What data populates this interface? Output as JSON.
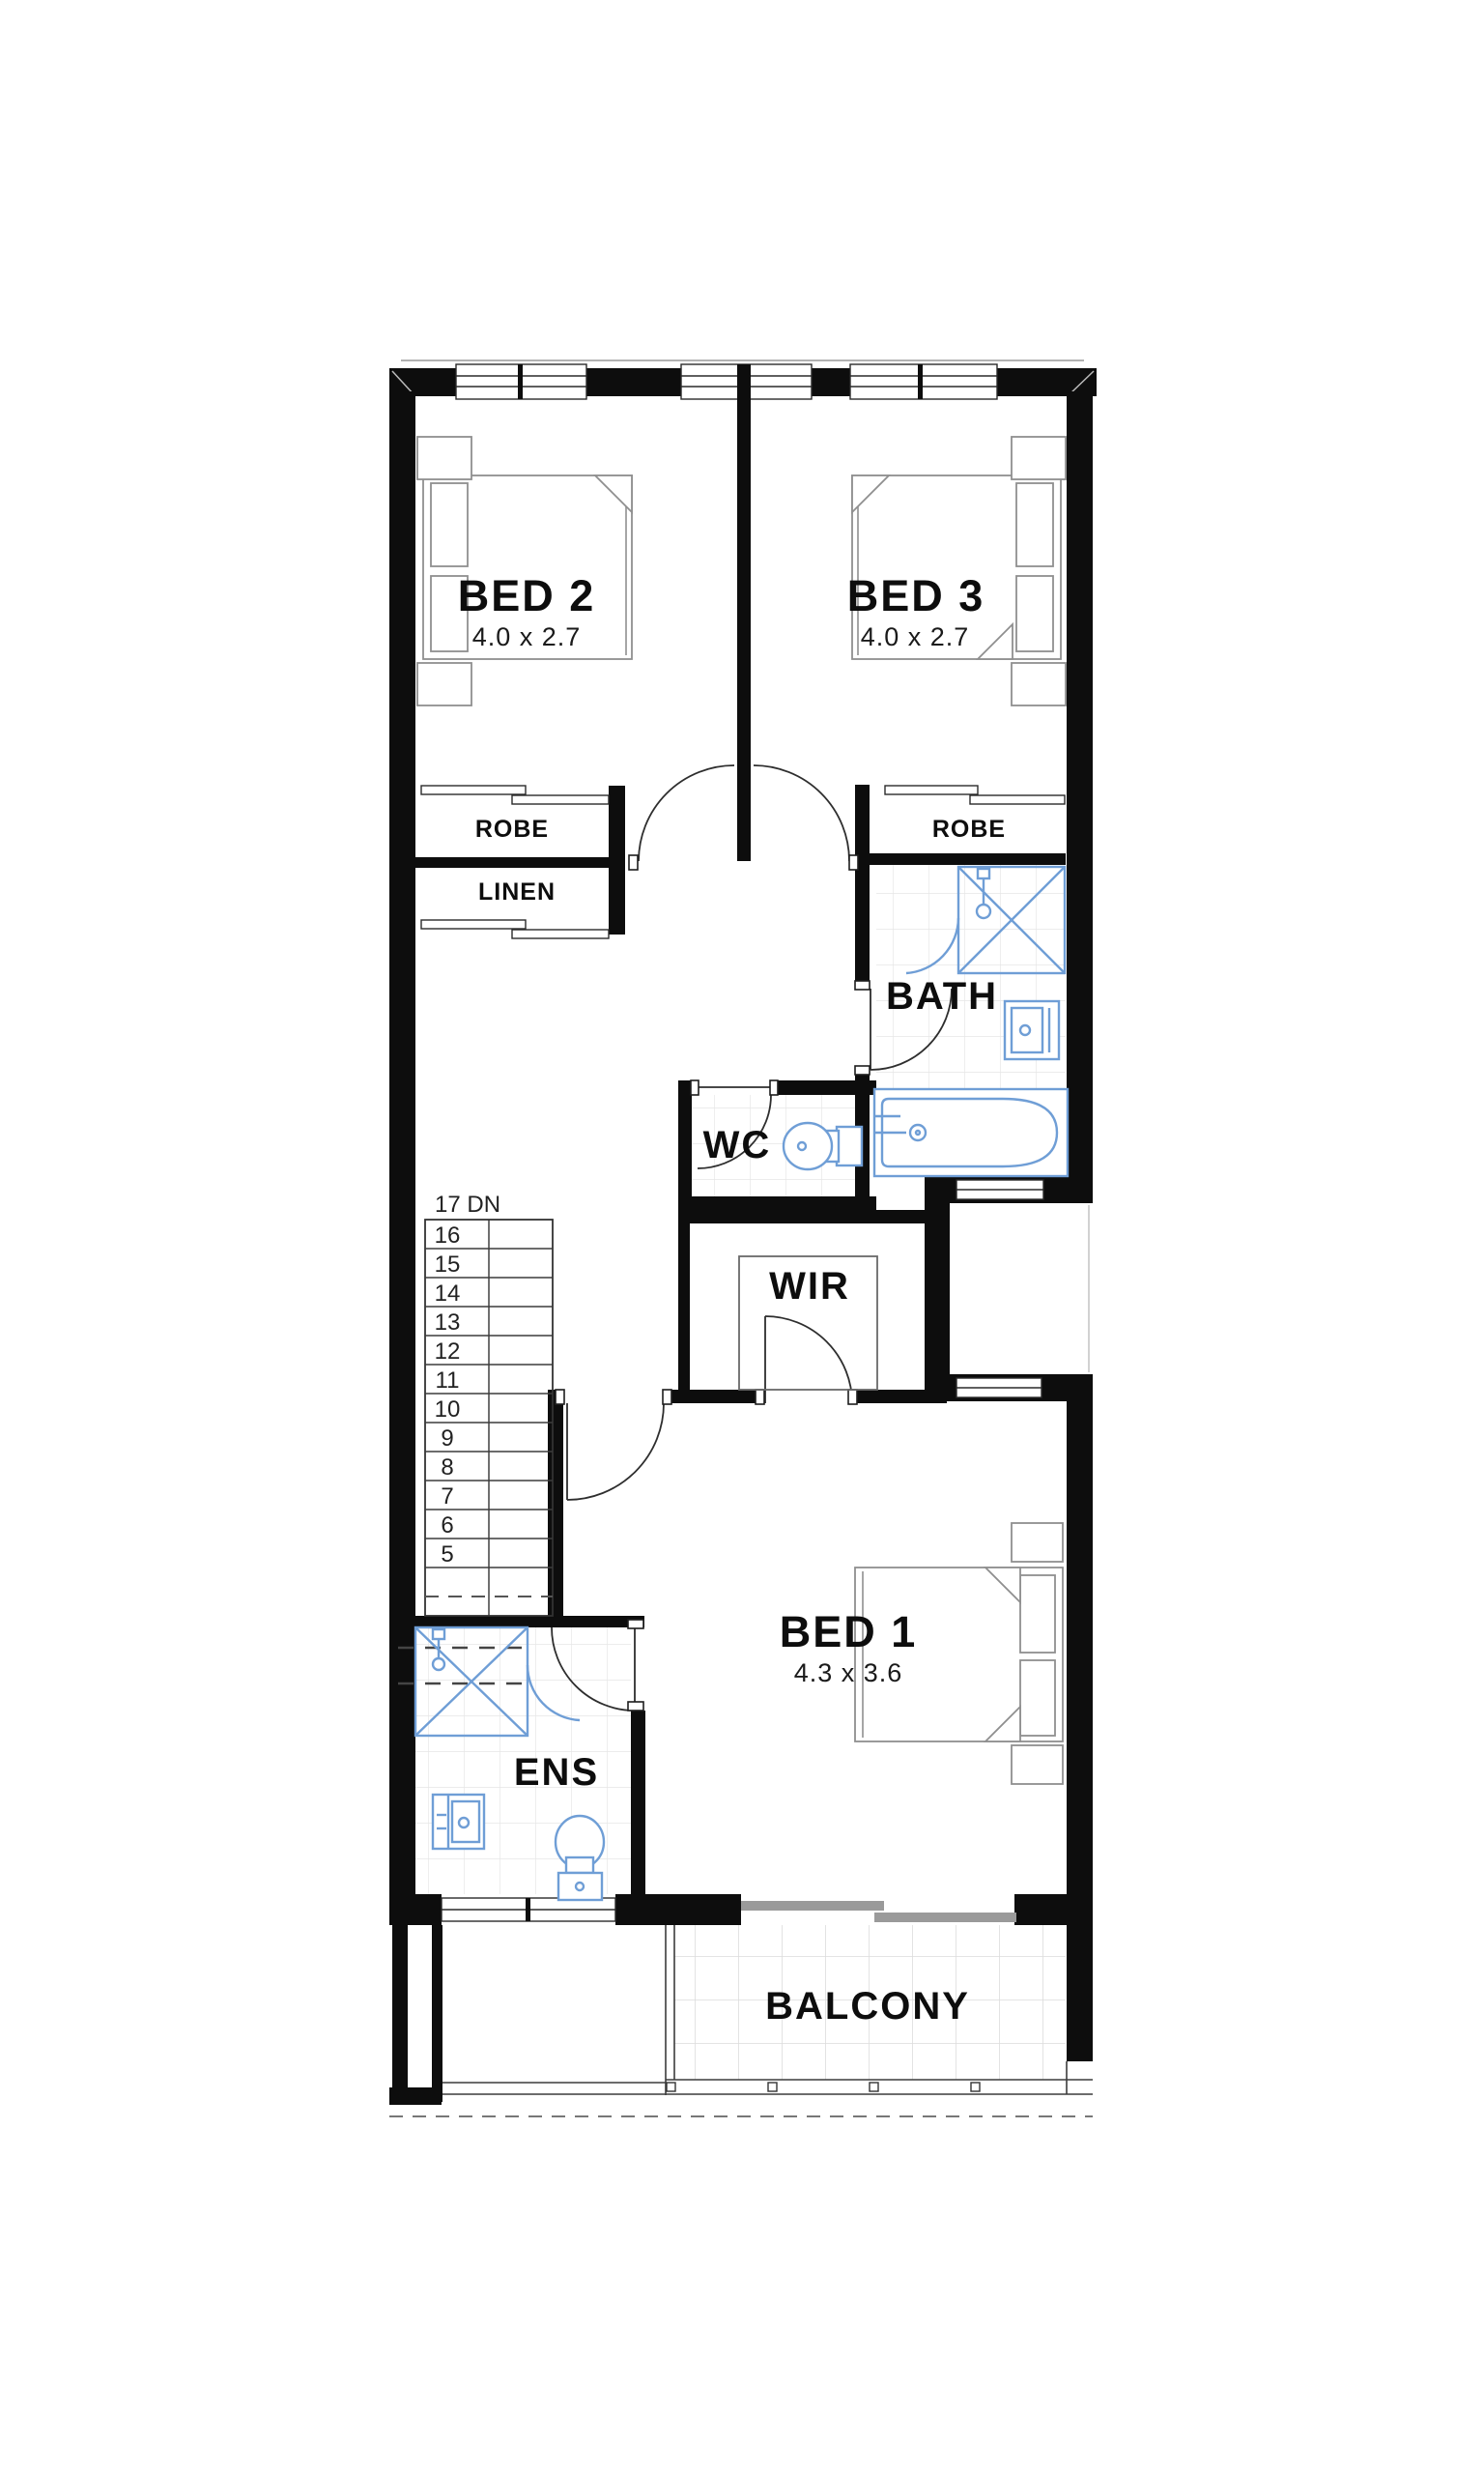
{
  "plan": {
    "rooms": {
      "bed2": {
        "label": "BED 2",
        "dim": "4.0 x 2.7"
      },
      "bed3": {
        "label": "BED 3",
        "dim": "4.0 x 2.7"
      },
      "bed1": {
        "label": "BED 1",
        "dim": "4.3 x 3.6"
      },
      "robe2": {
        "label": "ROBE"
      },
      "robe3": {
        "label": "ROBE"
      },
      "linen": {
        "label": "LINEN"
      },
      "bath": {
        "label": "BATH"
      },
      "wc": {
        "label": "WC"
      },
      "wir": {
        "label": "WIR"
      },
      "ens": {
        "label": "ENS"
      },
      "balcony": {
        "label": "BALCONY"
      }
    },
    "stairs": {
      "label": "17 DN",
      "treads": [
        "16",
        "15",
        "14",
        "13",
        "12",
        "11",
        "10",
        "9",
        "8",
        "7",
        "6",
        "5"
      ]
    },
    "colors": {
      "wall": "#0d0d0d",
      "fixture_blue": "#6f9ed6",
      "tile_line": "#e6e6e6",
      "line": "#3c3c3c"
    }
  }
}
